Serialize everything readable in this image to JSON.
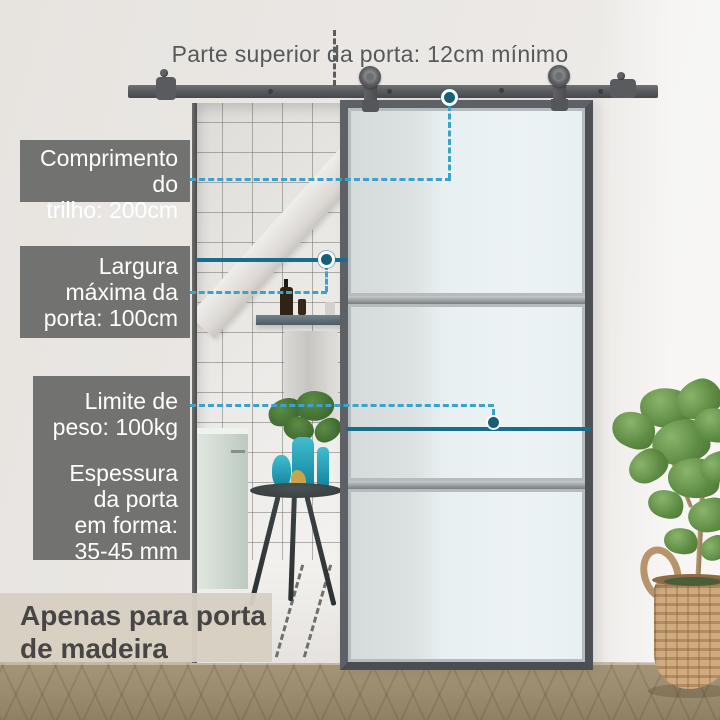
{
  "top_note": {
    "text": "Parte superior da porta: 12cm mínimo"
  },
  "callouts": {
    "track_length": {
      "line1": "Comprimento do",
      "line2": "trilho: 200cm"
    },
    "door_width": {
      "line1": "Largura",
      "line2": "máxima da",
      "line3": "porta: 100cm"
    },
    "weight_limit": {
      "line1": "Limite de",
      "line2": "peso: 100kg"
    },
    "door_thickness": {
      "line1": "Espessura",
      "line2": "da porta",
      "line3": "em forma:",
      "line4": "35-45 mm"
    }
  },
  "footer_note": {
    "line1": "Apenas para porta",
    "line2": "de madeira"
  },
  "colors": {
    "callout_bg": "#6d6d6d",
    "callout_text": "#ffffff",
    "note_text": "#57585a",
    "footer_bg": "#d6cfc2",
    "footer_text": "#474645",
    "leader_dashed": "#3aa2cb",
    "leader_solid": "#186d8c",
    "anchor_dot": "#175f78",
    "hardware_gray": "#595b5e",
    "glass_tint": "#e9f1f3",
    "vase_teal": "#2aa9bf"
  }
}
